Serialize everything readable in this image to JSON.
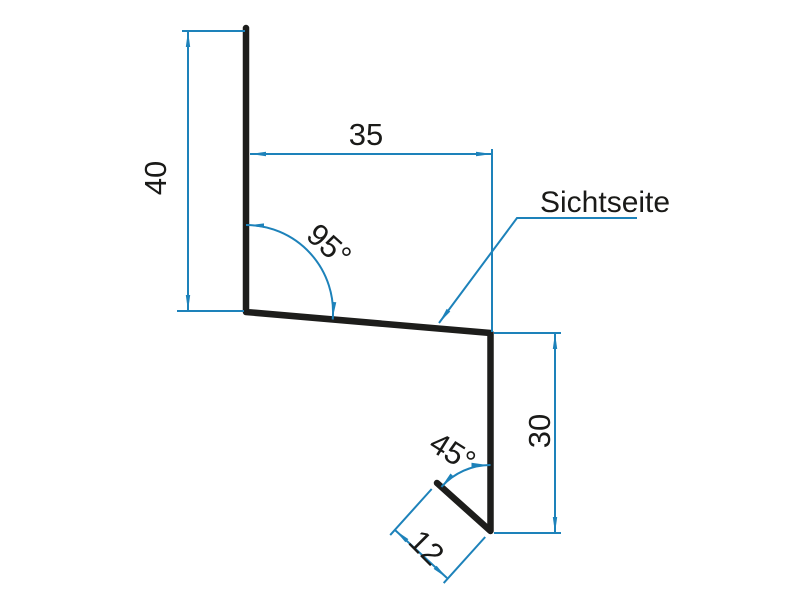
{
  "diagram": {
    "kind": "sheet-metal-profile-cross-section",
    "labels": {
      "dim_left_height": "40",
      "dim_top_width": "35",
      "dim_right_height": "30",
      "dim_hem_length": "12",
      "angle_upper": "95°",
      "angle_lower": "45°",
      "leader_text": "Sichtseite"
    },
    "dimensions_mm": {
      "left_height": 40,
      "top_width": 35,
      "right_height": 30,
      "hem_length": 12,
      "upper_angle_deg": 95,
      "lower_angle_deg": 45
    },
    "colors": {
      "dimension_blue": "#1d82ba",
      "profile_black": "#1d1d1b",
      "text_black": "#1a1a18",
      "background": "#ffffff"
    }
  }
}
